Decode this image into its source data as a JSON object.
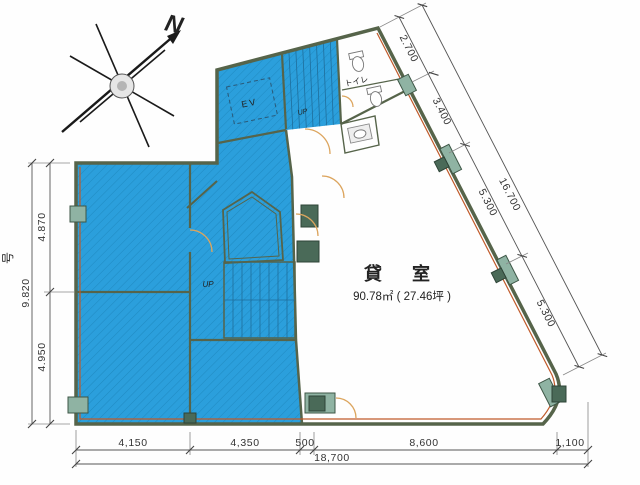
{
  "compass": {
    "north_label": "N"
  },
  "labels": {
    "rental_name": "貸　室",
    "rental_area": "90.78㎡ ( 27.46坪 )",
    "elevator": "EV",
    "toilet": "トイレ",
    "up_upper": "UP",
    "up_center": "UP",
    "left_edge": "号"
  },
  "dims": {
    "left": {
      "upper": "4.870",
      "total": "9.820",
      "lower": "4.950"
    },
    "bottom": {
      "segments": [
        "4,150",
        "4,350",
        "500",
        "8,600",
        "1,100"
      ],
      "total": "18,700"
    },
    "diagonal": {
      "segments": [
        "2.700",
        "3.400",
        "5.300",
        "5.300"
      ],
      "total": "16.700"
    }
  },
  "colors": {
    "room_fill": "#2b9fdc",
    "hatch_line": "#1579ad",
    "wall": "#56644a",
    "accent_wall": "#c05a2a",
    "pillar": "#8fb3a3",
    "door_arc": "#dca55e"
  }
}
